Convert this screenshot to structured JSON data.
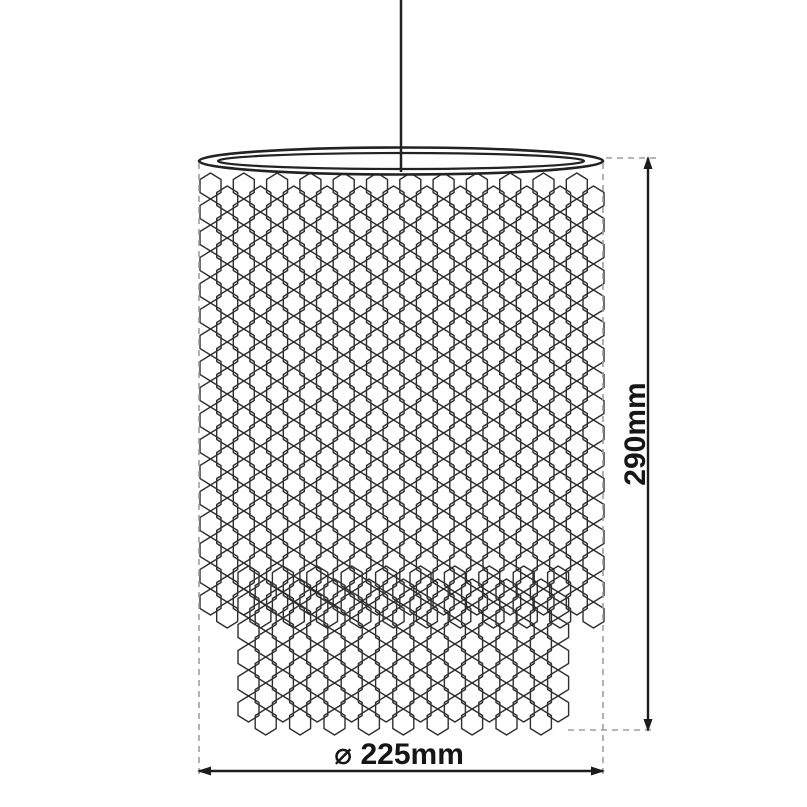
{
  "diagram": {
    "type": "product-dimension-drawing",
    "subject": "pendant-lampshade-hexagonal-mesh-two-tier",
    "dimensions": {
      "height_label": "290mm",
      "diameter_label": "⌀ 225mm"
    }
  },
  "colors": {
    "background": "#ffffff",
    "outline": "#222222",
    "mesh": "#2f2f2f",
    "dimension_line": "#1c1c1c",
    "extension_line": "#9e9e9e",
    "text": "#161616"
  }
}
